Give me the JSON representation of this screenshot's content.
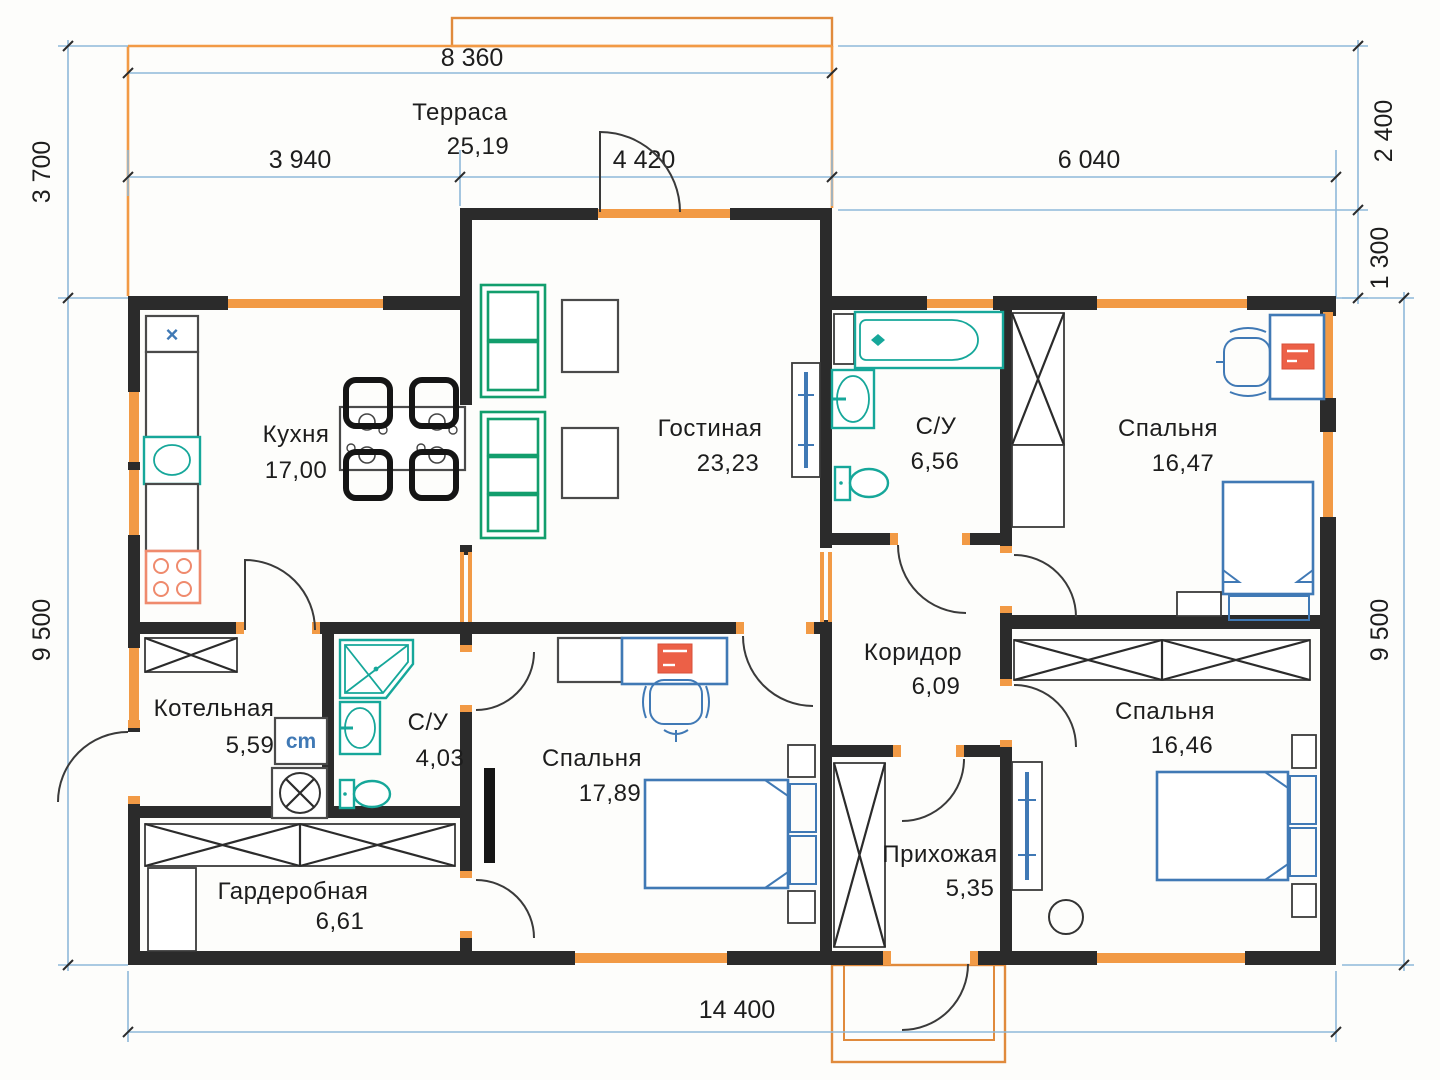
{
  "plan": {
    "title": "План одноэтажного дома",
    "rooms": [
      {
        "id": "terrace",
        "name": "Терраса",
        "area": "25,19"
      },
      {
        "id": "kitchen",
        "name": "Кухня",
        "area": "17,00"
      },
      {
        "id": "living-room",
        "name": "Гостиная",
        "area": "23,23"
      },
      {
        "id": "bathroom-main",
        "name": "С/У",
        "area": "6,56"
      },
      {
        "id": "bedroom-1",
        "name": "Спальня",
        "area": "16,47"
      },
      {
        "id": "boiler-room",
        "name": "Котельная",
        "area": "5,59"
      },
      {
        "id": "bathroom-small",
        "name": "С/У",
        "area": "4,03"
      },
      {
        "id": "bedroom-2",
        "name": "Спальня",
        "area": "17,89"
      },
      {
        "id": "corridor",
        "name": "Коридор",
        "area": "6,09"
      },
      {
        "id": "hallway",
        "name": "Прихожая",
        "area": "5,35"
      },
      {
        "id": "bedroom-3",
        "name": "Спальня",
        "area": "16,46"
      },
      {
        "id": "wardrobe",
        "name": "Гардеробная",
        "area": "6,61"
      }
    ],
    "dimensions": {
      "top_terrace": "8 360",
      "top_left": "3 940",
      "top_center": "4 420",
      "top_right": "6 040",
      "left_top": "3 700",
      "left_main": "9 500",
      "right_top": "2 400",
      "right_upper": "1 300",
      "right_main": "9 500",
      "bottom": "14 400"
    },
    "labels": {
      "washing_machine": "cm",
      "kitchen_vent": "×"
    },
    "colors": {
      "wall": "#2b2b2b",
      "window_orange": "#f29a45",
      "sanitary_teal": "#16a79a",
      "furniture_blue": "#4079b5",
      "sofa_green": "#129e6d",
      "accent_red": "#ec6047",
      "dimension_blue": "#8fb9d9"
    }
  }
}
